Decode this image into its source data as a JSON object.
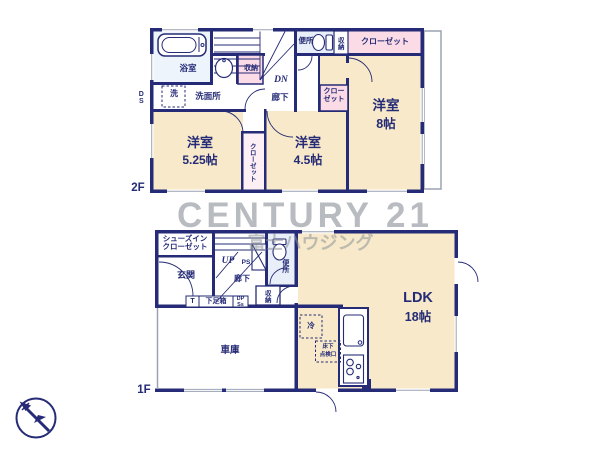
{
  "watermark": {
    "brand": "CENTURY 21",
    "company": "富士ハウジング"
  },
  "colors": {
    "wall": "#252b76",
    "room": "#f7e9c9",
    "closet": "#fbdce6",
    "wet_area": "#e9eff9",
    "watermark_gray": "#8c9298"
  },
  "floor2": {
    "label": "2F",
    "duct": "DS",
    "bath": "浴室",
    "laundry": "洗",
    "washroom": "洗面所",
    "storage_hall": "収納",
    "stairs_dn": "DN",
    "hallway": "廊下",
    "toilet": "便所",
    "toilet_storage": "収納",
    "closet_top": "クローゼット",
    "closet_small": "クローゼット",
    "closet_mid": "クローゼット",
    "room_west": {
      "name": "洋室",
      "size": "5.25帖"
    },
    "room_center": {
      "name": "洋室",
      "size": "4.5帖"
    },
    "room_east": {
      "name": "洋室",
      "size": "8帖"
    }
  },
  "floor1": {
    "label": "1F",
    "shoes_closet": "シューズインクローゼット",
    "entrance": "玄関",
    "stairs_up": "UP",
    "pipe_space": "PS",
    "hallway": "廊下",
    "toilet": "便所",
    "storage": "収納",
    "shoe_t": "T",
    "shoe_box": "下足箱",
    "shoe_dp": "DP",
    "shoe_ss": "Ss",
    "garage": "車庫",
    "ldk": {
      "name": "LDK",
      "size": "18帖"
    },
    "fridge": "冷",
    "hatch": {
      "line1": "床下",
      "line2": "点検口"
    }
  }
}
